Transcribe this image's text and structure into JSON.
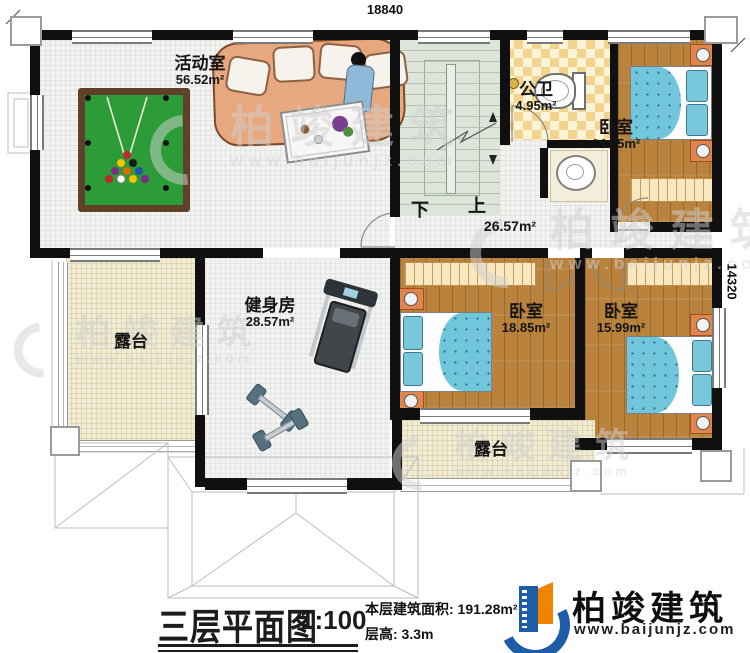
{
  "dimensions": {
    "top": "18840",
    "right": "14320"
  },
  "rooms": {
    "activity": {
      "label": "活动室",
      "area": "56.52m²"
    },
    "bathroom": {
      "label": "公卫",
      "area": "4.95m²"
    },
    "bedroom1": {
      "label": "卧室",
      "area": "14.65m²"
    },
    "bedroom2": {
      "label": "卧室",
      "area": "18.85m²"
    },
    "bedroom3": {
      "label": "卧室",
      "area": "15.99m²"
    },
    "gym": {
      "label": "健身房",
      "area": "28.57m²"
    },
    "hall": {
      "area": "26.57m²"
    },
    "terrace_left": {
      "label": "露台"
    },
    "terrace_bottom": {
      "label": "露台"
    }
  },
  "stairs": {
    "down": "下",
    "up": "上"
  },
  "title_block": {
    "title": "三层平面图",
    "scale": "1:100",
    "area_line": "本层建筑面积: 191.28m²",
    "height_line": "层高: 3.3m"
  },
  "brand": {
    "name": "柏竣建筑",
    "url": "www.baijunjz.com"
  },
  "watermark": {
    "name": "柏竣建筑",
    "url": "www.baijunjz.com"
  },
  "colors": {
    "wall": "#101010",
    "wood_floor": "#b9823d",
    "bed_blue": "#72c6dc",
    "pool_felt_green": "#2c9c39",
    "terrace_cream": "#f0ebd2",
    "logo_blue": "#1d5ca6",
    "logo_orange": "#f08300"
  }
}
